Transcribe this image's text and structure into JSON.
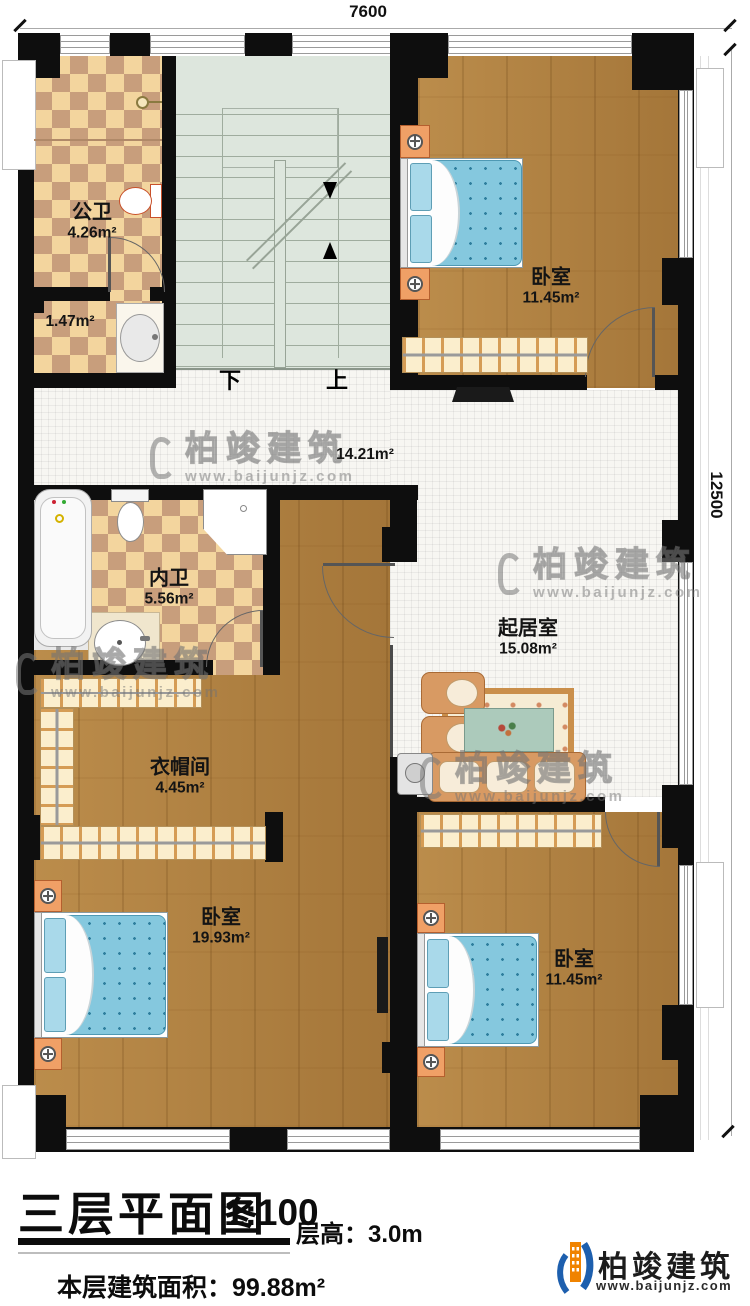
{
  "dimensions": {
    "width_top": "7600",
    "height_right": "12500"
  },
  "stairs": {
    "down_label": "下",
    "up_label": "上"
  },
  "rooms": {
    "public_bath": {
      "name": "公卫",
      "area": "4.26m²"
    },
    "bath_lobby": {
      "area": "1.47m²"
    },
    "bedroom_top_right": {
      "name": "卧室",
      "area": "11.45m²"
    },
    "hallway": {
      "area": "14.21m²"
    },
    "private_bath": {
      "name": "内卫",
      "area": "5.56m²"
    },
    "living_room": {
      "name": "起居室",
      "area": "15.08m²"
    },
    "cloakroom": {
      "name": "衣帽间",
      "area": "4.45m²"
    },
    "bedroom_bottom_left": {
      "name": "卧室",
      "area": "19.93m²"
    },
    "bedroom_bottom_right": {
      "name": "卧室",
      "area": "11.45m²"
    }
  },
  "title_block": {
    "title": "三层平面图",
    "scale": "1:100",
    "floor_height": "层高：3.0m",
    "floor_area": "本层建筑面积：99.88m²"
  },
  "branding": {
    "company": "柏竣建筑",
    "website": "www.baijunjz.com"
  },
  "watermark": {
    "company": "柏竣建筑",
    "website": "www.baijunjz.com"
  },
  "colors": {
    "wall": "#0e0e0e",
    "wood": "#b0803f",
    "tile_light": "#f3d59e",
    "tile_dark": "#c89e7c",
    "stair": "#dde6dd",
    "bed_blue": "#85c8de",
    "closet": "#fbeecd",
    "logo_blue": "#1d5fae",
    "logo_orange": "#f08300"
  }
}
